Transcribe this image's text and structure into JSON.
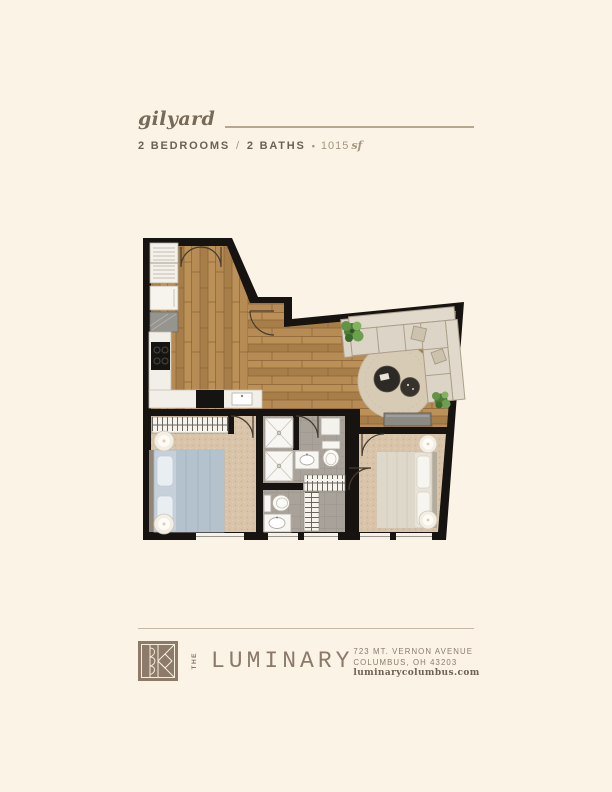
{
  "header": {
    "plan_name": "gilyard",
    "bedrooms_label": "2 BEDROOMS",
    "separator": "/",
    "baths_label": "2 BATHS",
    "bullet": "•",
    "area_value": "1015",
    "area_unit": "sf"
  },
  "floor_plan": {
    "description": "2 bedroom / 2 bath unit floor plan",
    "rooms": [
      "entry",
      "kitchen",
      "living-room",
      "bedroom-left",
      "bedroom-right",
      "bath-1",
      "bath-2",
      "closets",
      "laundry"
    ]
  },
  "footer": {
    "brand_the": "THE",
    "brand_name": "LUMINARY",
    "address_line1": "723 MT. VERNON AVENUE",
    "address_line2": "COLUMBUS, OH 43203",
    "website": "luminarycolumbus.com"
  },
  "palette": {
    "background": "#faf3e6",
    "wall": "#171310",
    "wood": "#b1874f",
    "carpet": "#d9c3a9",
    "bath_tile": "#a8a29a",
    "heading_text": "#796a58",
    "spec_text": "#6c6153",
    "muted_text": "#a3977f",
    "brand": "#8b7a6a"
  }
}
